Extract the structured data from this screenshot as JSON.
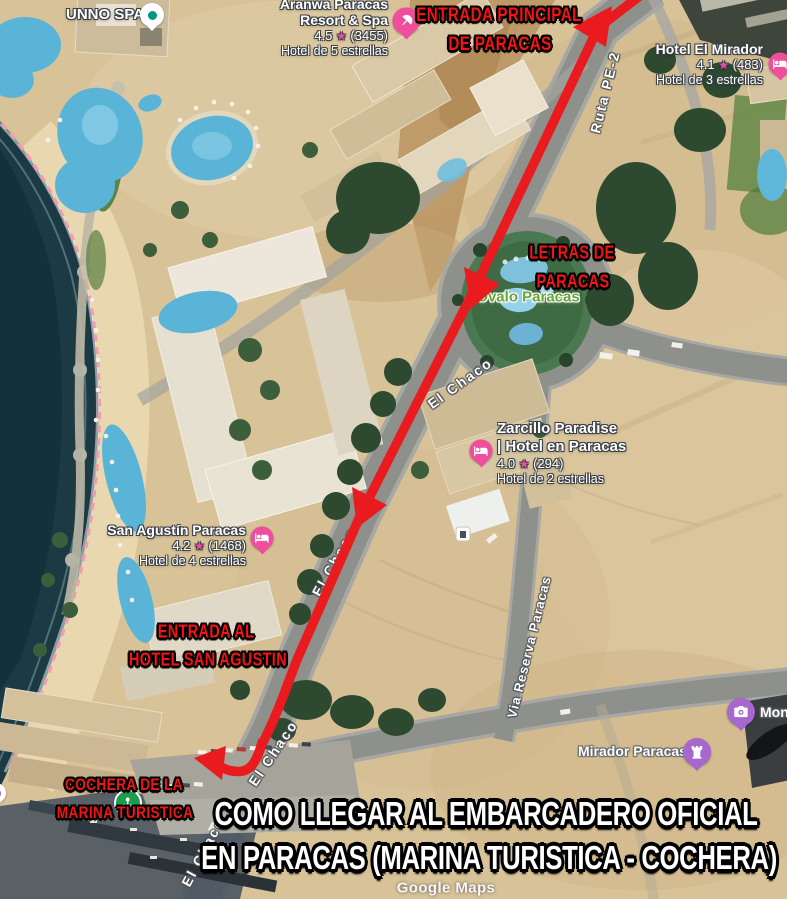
{
  "attribution": "Google Maps",
  "icons": {
    "star": "★"
  },
  "colors": {
    "route_red": "#ea1b1e",
    "annotation_red": "#f31414",
    "hotel_pin_pink": "#ee4e9b",
    "attraction_pin_purple": "#a667cf",
    "cochera_pin_green": "#1b9e4b",
    "park_label_green": "#68a437"
  },
  "places": {
    "unno": {
      "name": "UNNO SPA"
    },
    "aranwa": {
      "name_line1": "Aranwa Paracas",
      "name_line2": "Resort & Spa",
      "rating": "4.5",
      "reviews": "(3455)",
      "category": "Hotel de 5 estrellas"
    },
    "el_mirador": {
      "name": "Hotel El Mirador",
      "rating": "4.1",
      "reviews": "(483)",
      "category": "Hotel de 3 estrellas"
    },
    "zarcillo": {
      "name_line1": "Zarcillo Paradise",
      "name_line2": "| Hotel en Paracas",
      "rating": "4.0",
      "reviews": "(294)",
      "category": "Hotel de 2 estrellas"
    },
    "san_agustin": {
      "name": "San Agustín Paracas",
      "rating": "4.2",
      "reviews": "(1468)",
      "category": "Hotel de 4 estrellas"
    },
    "ovalo": {
      "name": "Ovalo Paracas"
    },
    "mirador_paracas": {
      "name": "Mirador Paracas"
    },
    "monumento_partial": {
      "name": "Mon"
    }
  },
  "roads": {
    "ruta_pe2": "Ruta PE-2",
    "el_chaco": "El Chaco",
    "via_reserva": "Via Reserva Paracas"
  },
  "annotations": {
    "entrada_principal": {
      "line1": "ENTRADA PRINCIPAL",
      "line2": "DE PARACAS"
    },
    "letras": {
      "line1": "LETRAS DE",
      "line2": "PARACAS"
    },
    "entrada_hotel": {
      "line1": "ENTRADA AL",
      "line2": "HOTEL SAN AGUSTIN"
    },
    "cochera": {
      "line1": "COCHERA DE LA",
      "line2": "MARINA TURISTICA"
    }
  },
  "banner": {
    "line1": "COMO LLEGAR AL EMBARCADERO OFICIAL",
    "line2": "EN PARACAS (MARINA TURISTICA - COCHERA)"
  }
}
